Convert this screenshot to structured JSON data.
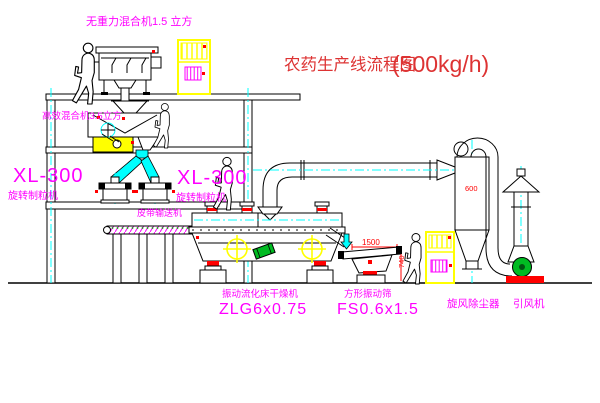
{
  "title": {
    "cn": "农药生产线流程图",
    "capacity": "(500kg/h)"
  },
  "labels": {
    "gravity_free_mixer": "无重力混合机1.5 立方",
    "high_efficiency_mixer": "高效混合机3.5立方",
    "granulator_left_model": "XL-300",
    "granulator_left_name": "旋转制粒机",
    "granulator_right_model": "XL-300",
    "granulator_right_name": "旋转制粒机",
    "belt_conveyor": "皮带输送机",
    "dryer_name": "振动流化床干燥机",
    "dryer_model": "ZLG6x0.75",
    "sieve_name": "方形振动筛",
    "sieve_model": "FS0.6x1.5",
    "cyclone_name": "旋风除尘器",
    "fan_name": "引风机"
  },
  "dimensions": {
    "sieve_length": "1500",
    "sieve_height": "740",
    "cyclone_diameter": "600"
  },
  "colors": {
    "label_magenta": "#ff00ff",
    "title_red": "#dd3333",
    "dimension_red": "#ff0000",
    "highlight_yellow": "#ffff00",
    "centerline_cyan": "#00ffff",
    "motor_green": "#00bb22",
    "line_black": "#000000",
    "background": "#ffffff"
  }
}
